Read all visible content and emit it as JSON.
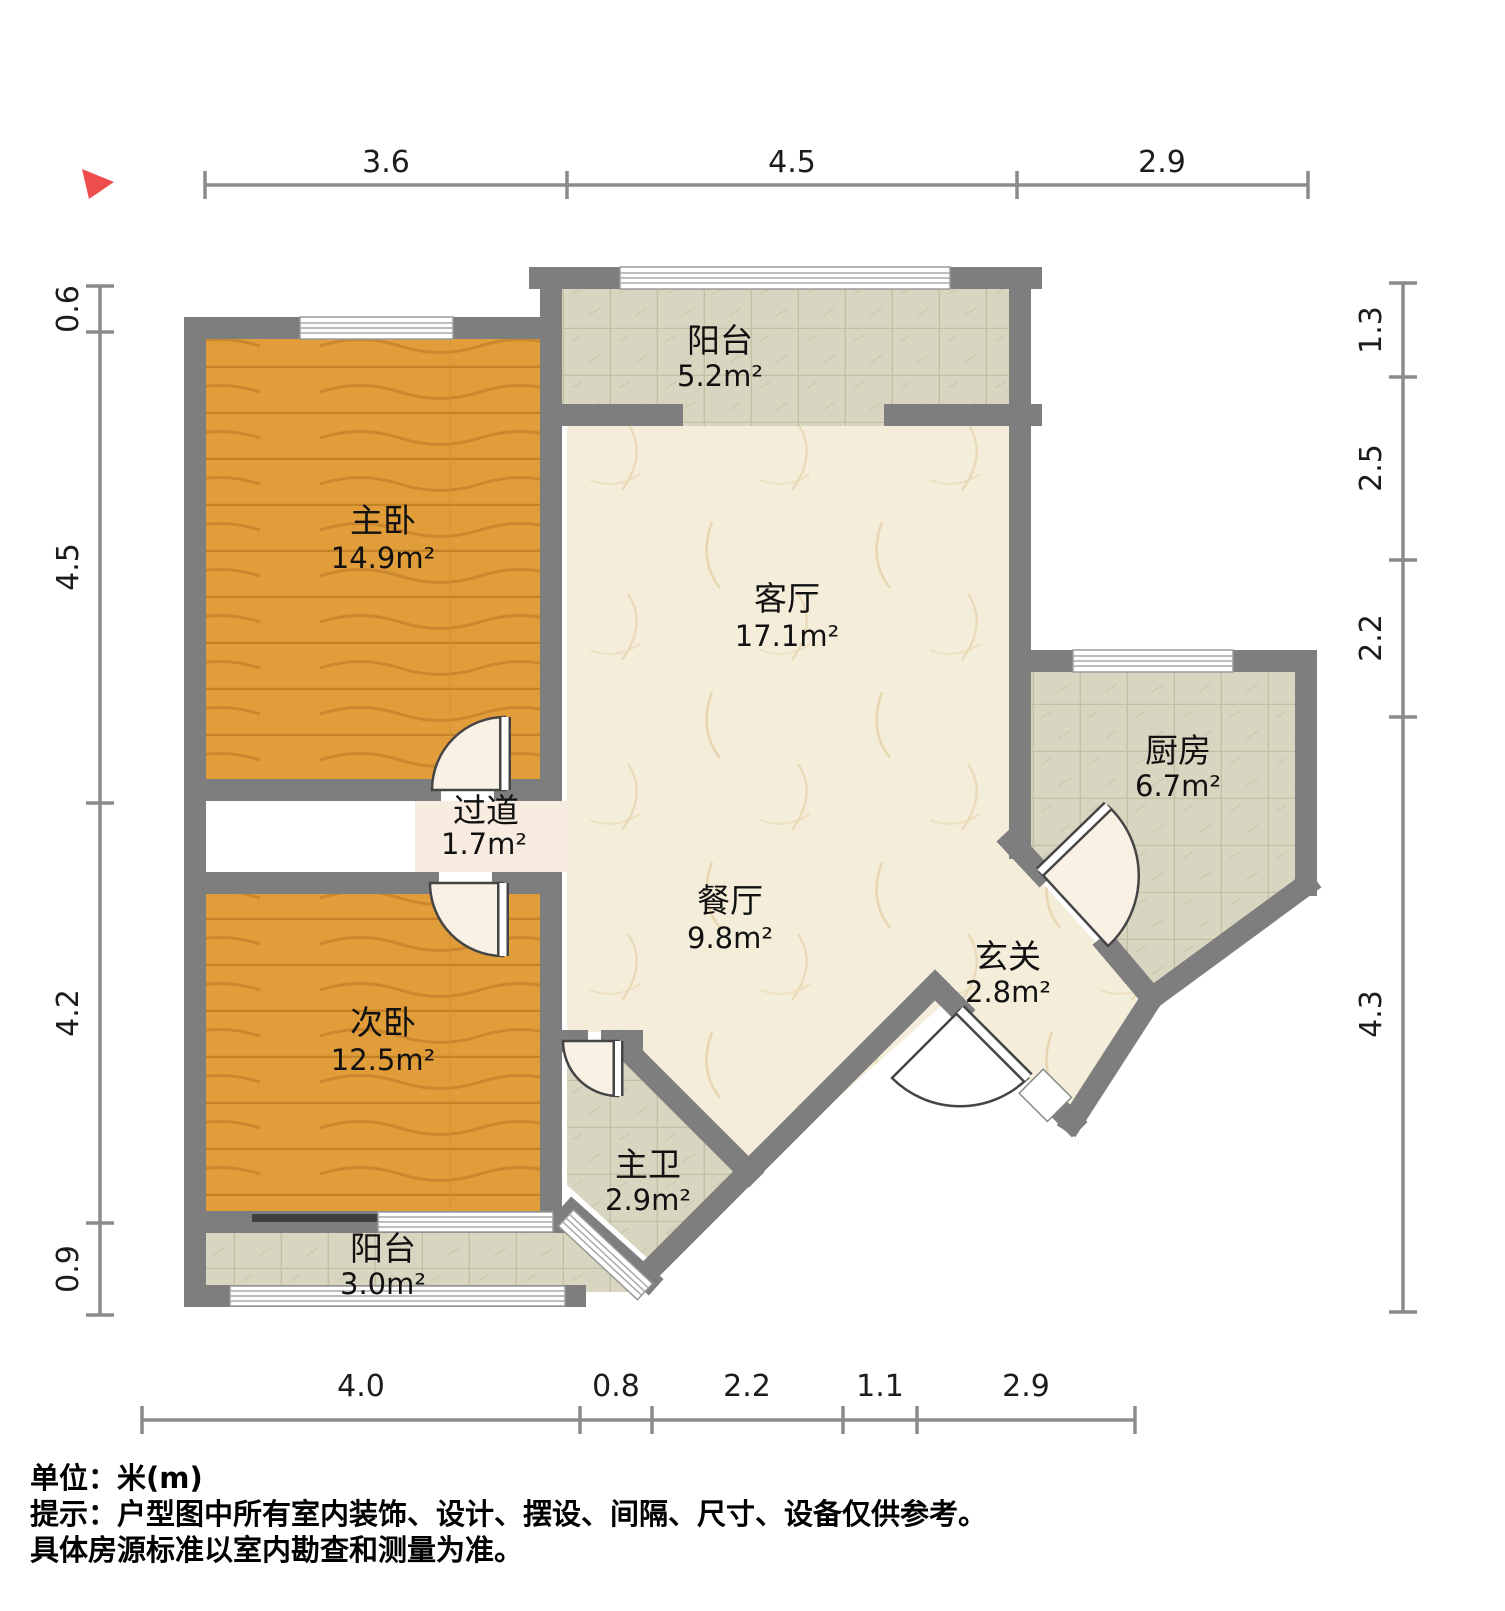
{
  "compass": {
    "icon": "north-arrow"
  },
  "rooms": [
    {
      "id": "balcony-top",
      "name": "阳台",
      "area": "5.2m²"
    },
    {
      "id": "master-bedroom",
      "name": "主卧",
      "area": "14.9m²"
    },
    {
      "id": "living-room",
      "name": "客厅",
      "area": "17.1m²"
    },
    {
      "id": "kitchen",
      "name": "厨房",
      "area": "6.7m²"
    },
    {
      "id": "hallway",
      "name": "过道",
      "area": "1.7m²"
    },
    {
      "id": "dining-room",
      "name": "餐厅",
      "area": "9.8m²"
    },
    {
      "id": "entrance",
      "name": "玄关",
      "area": "2.8m²"
    },
    {
      "id": "second-bedroom",
      "name": "次卧",
      "area": "12.5m²"
    },
    {
      "id": "master-bath",
      "name": "主卫",
      "area": "2.9m²"
    },
    {
      "id": "balcony-bottom",
      "name": "阳台",
      "area": "3.0m²"
    }
  ],
  "dimensions": {
    "top": [
      "3.6",
      "4.5",
      "2.9"
    ],
    "left": [
      "0.6",
      "4.5",
      "4.2",
      "0.9"
    ],
    "right": [
      "1.3",
      "2.5",
      "2.2",
      "4.3"
    ],
    "bottom": [
      "4.0",
      "0.8",
      "2.2",
      "1.1",
      "2.9"
    ]
  },
  "notes": {
    "line1": "单位：米(m)",
    "line2": "提示：户型图中所有室内装饰、设计、摆设、间隔、尺寸、设备仅供参考。",
    "line3": "具体房源标准以室内勘查和测量为准。"
  },
  "colors": {
    "wall": "#7e7e7e",
    "wood": "#e19d39",
    "tile": "#d8d5c0",
    "marble": "#f4edda",
    "compass_red": "#ee4d4d",
    "dimension_line": "#8b8b8b"
  }
}
